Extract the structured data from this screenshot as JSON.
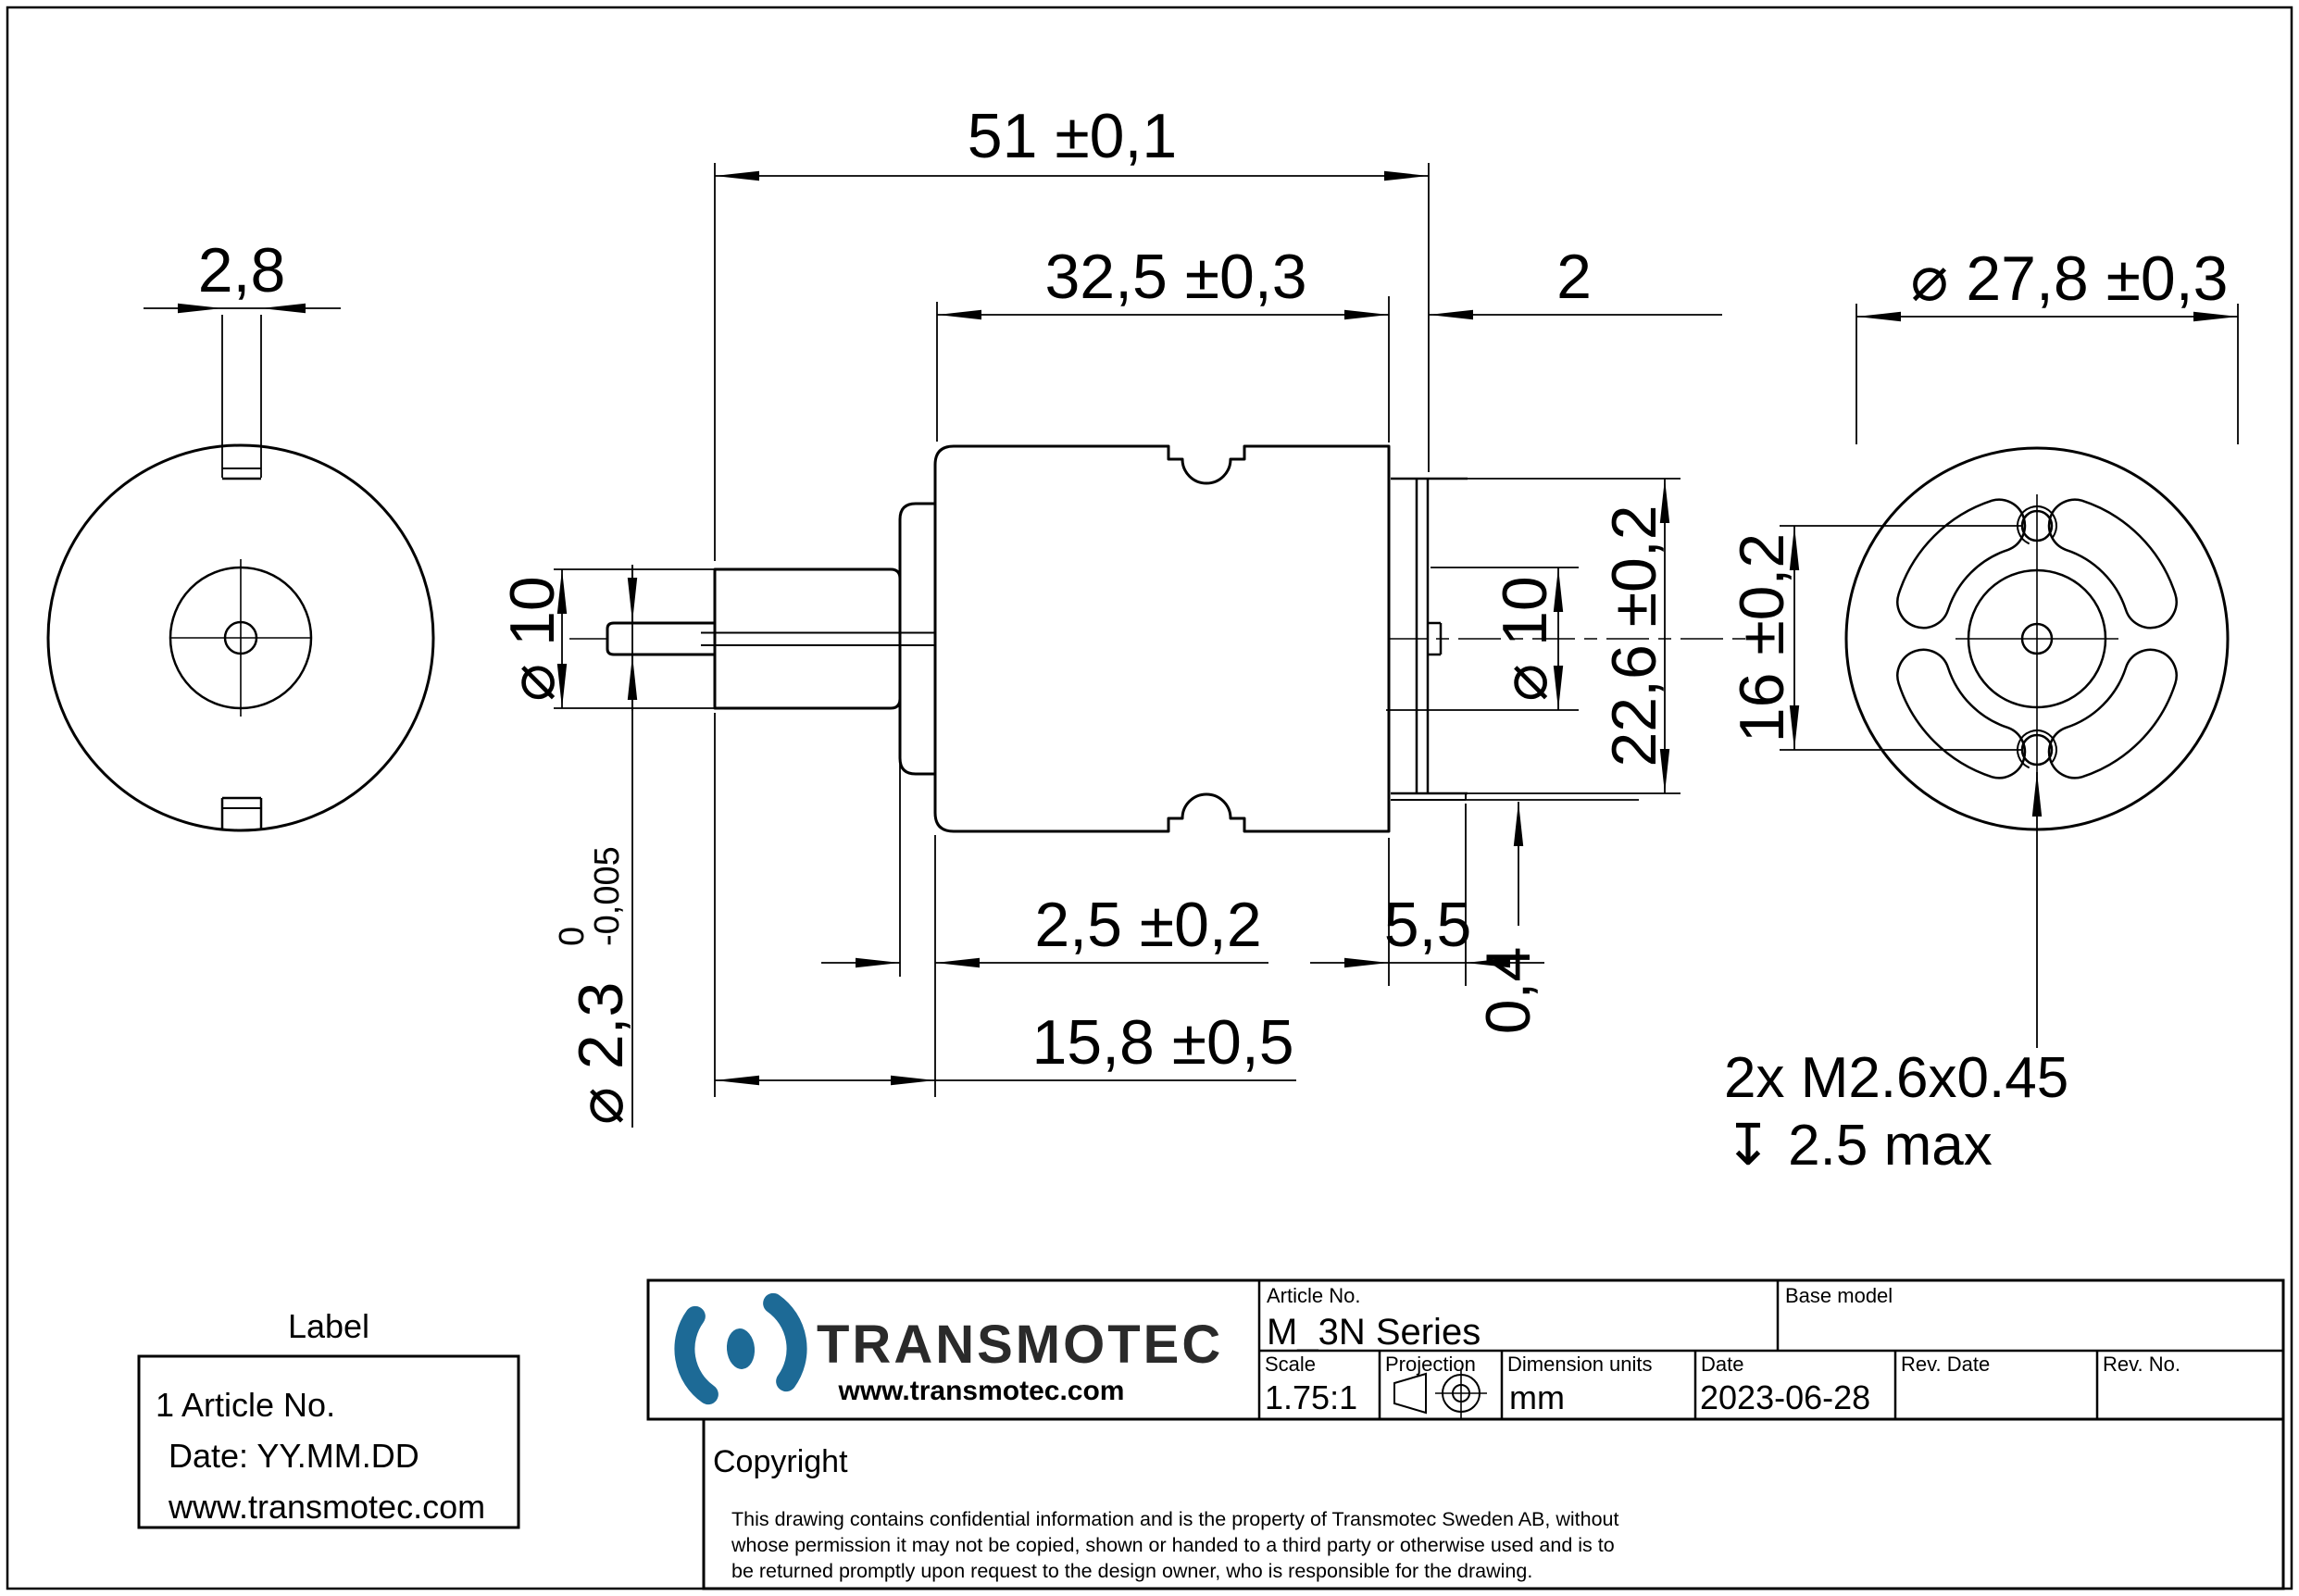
{
  "dims": {
    "overall_length": "51 ±0,1",
    "can_length": "32,5 ±0,3",
    "rear_cap_thickness": "2",
    "rear_face_diameter": "⌀ 27,8 ±0,3",
    "tab_width": "2,8",
    "front_boss_diameter": "⌀ 10",
    "rear_boss_diameter": "⌀ 10",
    "shaft_diameter": "⌀ 2,3",
    "shaft_tolerance_upper": "0",
    "shaft_tolerance_lower": "-0,005",
    "endbell_thickness": "2,5 ±0,2",
    "front_section_length": "15,8 ±0,5",
    "rear_section_length": "5,5",
    "rear_flat_width": "22,6 ±0,2",
    "plate_offset": "0,4",
    "mount_hole_spacing": "16 ±0,2",
    "mount_thread_note": "2x M2.6x0.45",
    "mount_thread_depth": "↧ 2.5 max"
  },
  "label_box": {
    "heading": "Label",
    "lines": [
      "1 Article No.",
      "Date: YY.MM.DD",
      "www.transmotec.com"
    ]
  },
  "title_block": {
    "brand": "TRANSMOTEC",
    "website": "www.transmotec.com",
    "article_label": "Article No.",
    "article_value": "M_3N Series",
    "base_model_label": "Base model",
    "scale_label": "Scale",
    "scale_value": "1.75:1",
    "projection_label": "Projection",
    "units_label": "Dimension units",
    "units_value": "mm",
    "date_label": "Date",
    "date_value": "2023-06-28",
    "rev_date_label": "Rev. Date",
    "rev_no_label": "Rev. No.",
    "copyright_heading": "Copyright",
    "copyright_lines": [
      "This drawing contains confidential information and is the property of Transmotec Sweden AB, without",
      "whose permission it may not be copied, shown or handed to a third party or otherwise used and is to",
      "be returned promptly upon request to the design owner, who is responsible for the drawing."
    ]
  },
  "colors": {
    "brand_blue": "#1d6a96",
    "line": "#000000"
  }
}
